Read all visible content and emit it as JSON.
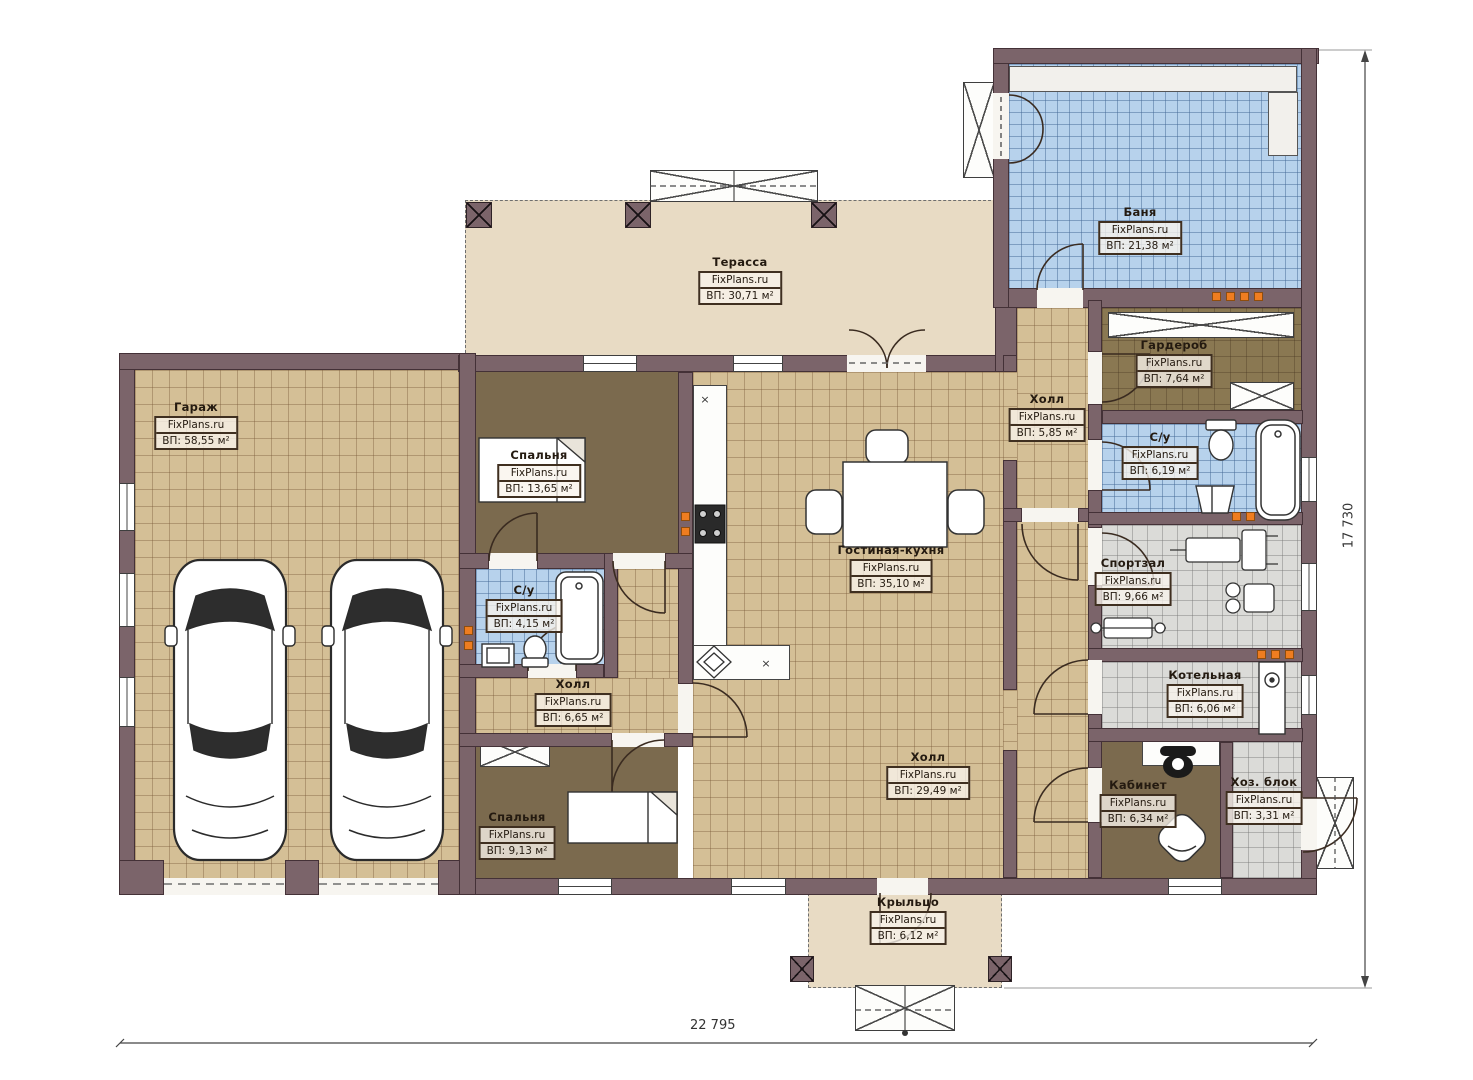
{
  "plan": {
    "brand": "FixPlans.ru",
    "dimensions": {
      "width_label": "22 795",
      "height_label": "17 730"
    },
    "rooms": [
      {
        "key": "garage",
        "name": "Гараж",
        "area": "ВП: 58,55 м²"
      },
      {
        "key": "terrace",
        "name": "Терасса",
        "area": "ВП: 30,71 м²"
      },
      {
        "key": "banya",
        "name": "Баня",
        "area": "ВП: 21,38 м²"
      },
      {
        "key": "bedroom1",
        "name": "Спальня",
        "area": "ВП: 13,65 м²"
      },
      {
        "key": "wardrobe",
        "name": "Гардероб",
        "area": "ВП: 7,64 м²"
      },
      {
        "key": "hall-small",
        "name": "Холл",
        "area": "ВП: 5,85 м²"
      },
      {
        "key": "bathroom2",
        "name": "С/у",
        "area": "ВП: 6,19 м²"
      },
      {
        "key": "living-kitchen",
        "name": "Гостиная-кухня",
        "area": "ВП: 35,10 м²"
      },
      {
        "key": "bathroom1",
        "name": "С/у",
        "area": "ВП: 4,15 м²"
      },
      {
        "key": "hall-bedrooms",
        "name": "Холл",
        "area": "ВП: 6,65 м²"
      },
      {
        "key": "gym",
        "name": "Спортзал",
        "area": "ВП: 9,66 м²"
      },
      {
        "key": "boiler",
        "name": "Котельная",
        "area": "ВП: 6,06 м²"
      },
      {
        "key": "bedroom2",
        "name": "Спальня",
        "area": "ВП: 9,13 м²"
      },
      {
        "key": "hall-main",
        "name": "Холл",
        "area": "ВП: 29,49 м²"
      },
      {
        "key": "office",
        "name": "Кабинет",
        "area": "ВП: 6,34 м²"
      },
      {
        "key": "utility",
        "name": "Хоз. блок",
        "area": "ВП: 3,31 м²"
      },
      {
        "key": "porch",
        "name": "Крыльцо",
        "area": "ВП: 6,12 м²"
      }
    ],
    "colors": {
      "wall": "#7b646a",
      "tile_beige": "#d4bf96",
      "tile_blue": "#b7d2ec",
      "tile_gray": "#dbdbd8",
      "floor_brown": "#7b6a4e",
      "terrace": "#e8dbc4",
      "accent_orange": "#ef7d20"
    }
  }
}
